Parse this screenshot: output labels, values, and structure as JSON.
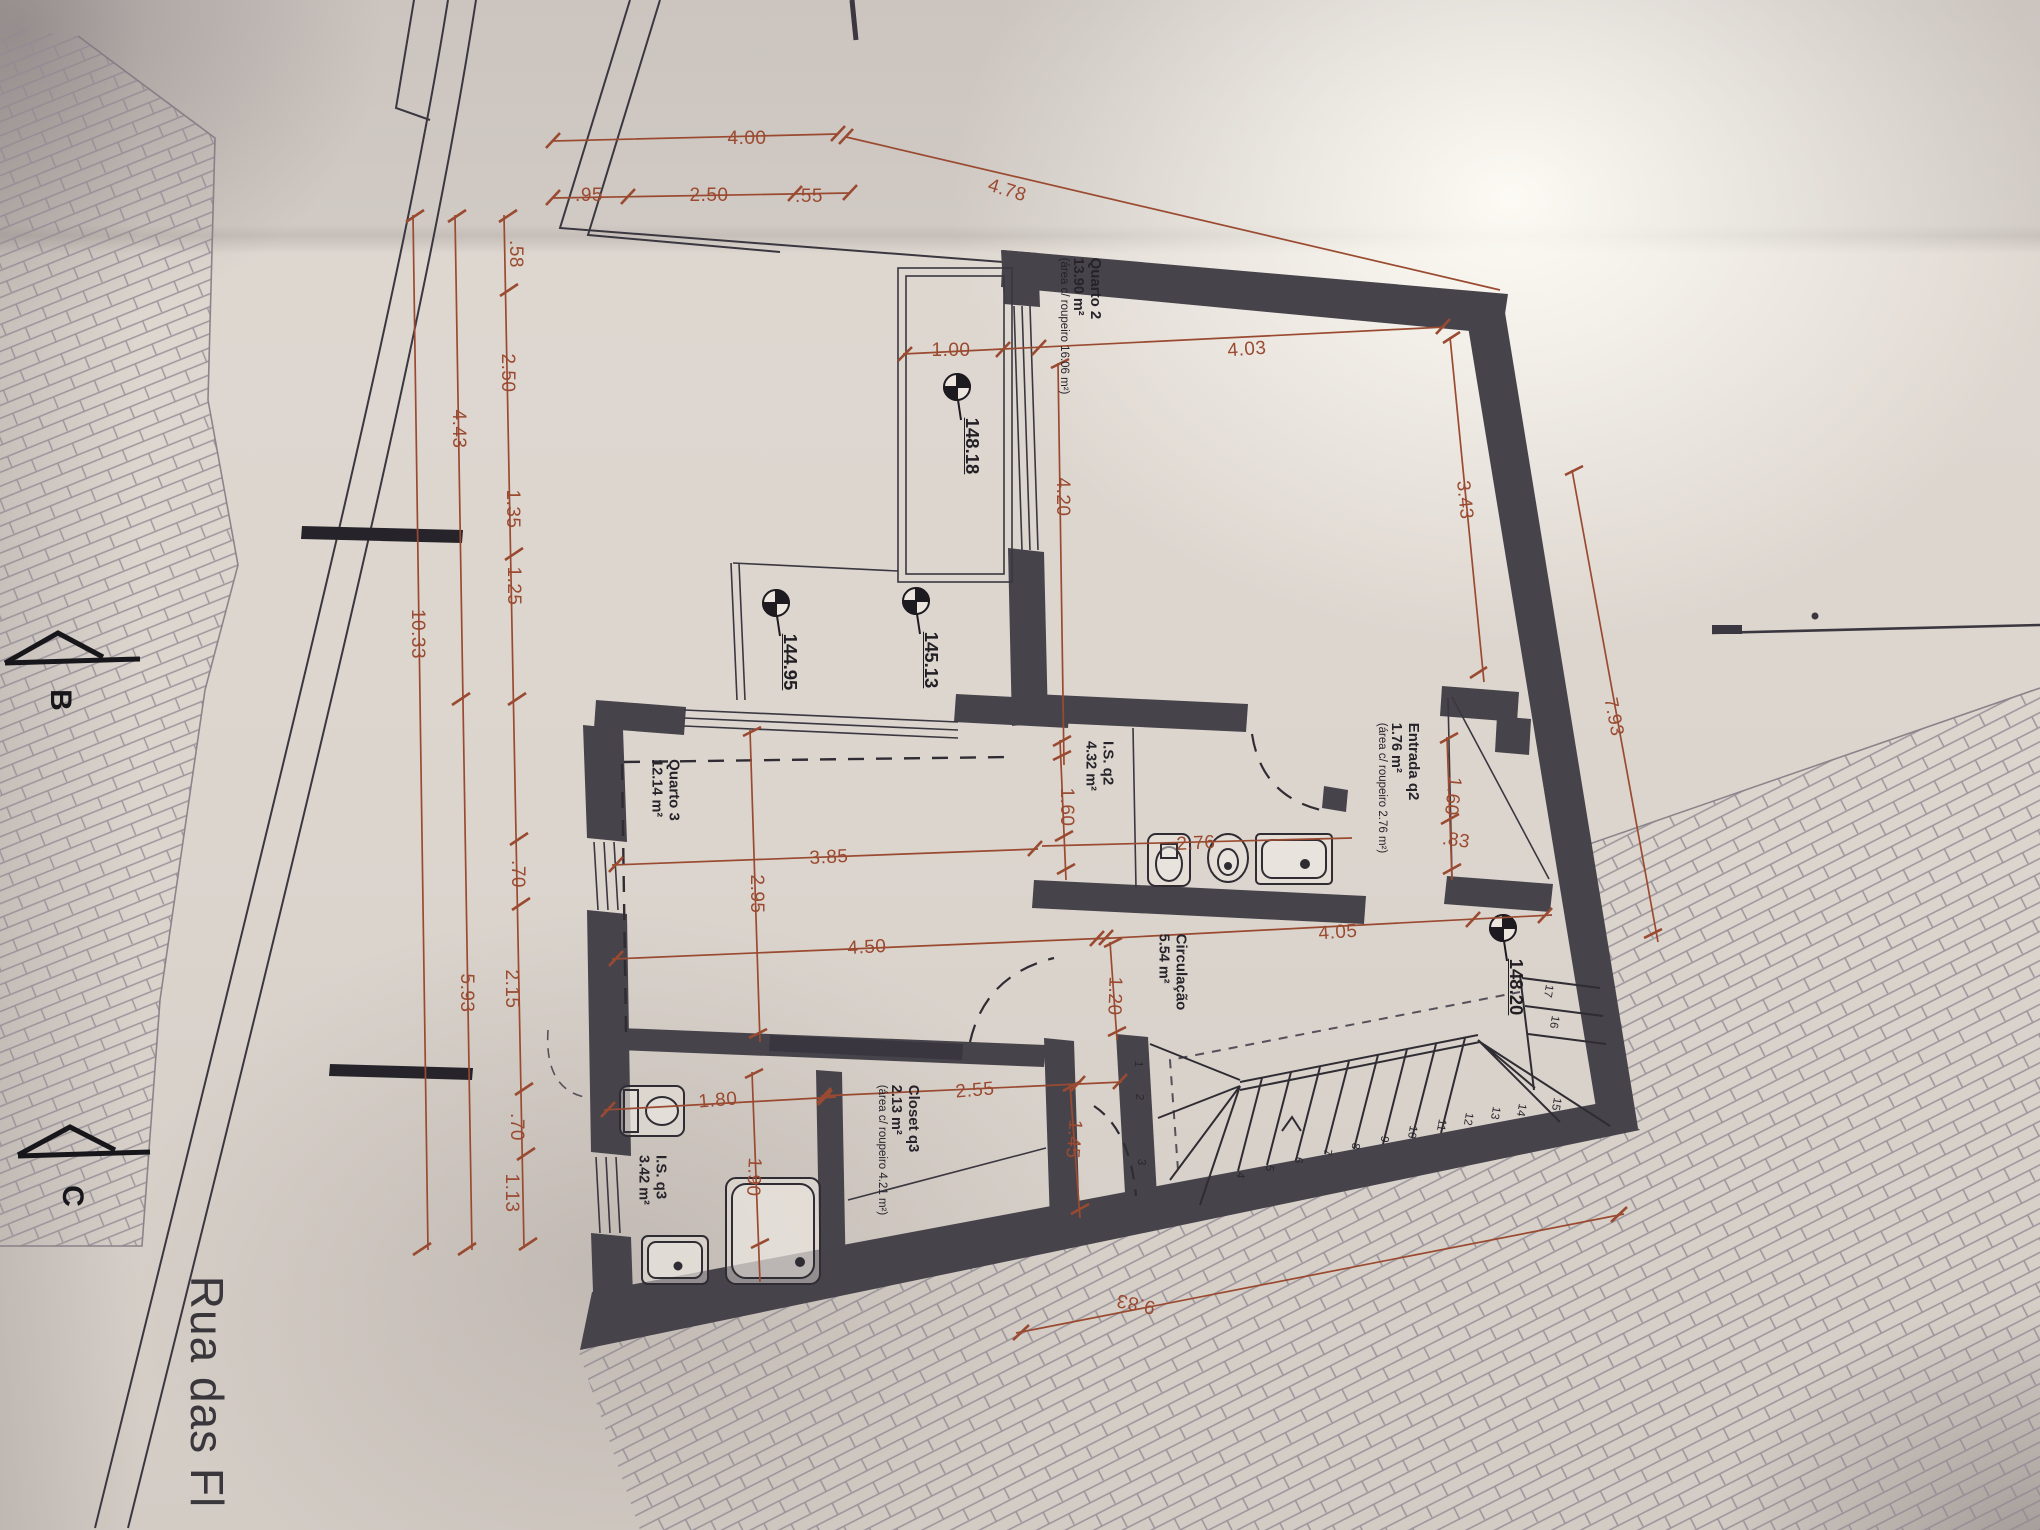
{
  "street": {
    "label": "Rua das Fl"
  },
  "sections": [
    {
      "label": "B"
    },
    {
      "label": "C"
    }
  ],
  "rooms": [
    {
      "name": "Quarto 2",
      "area": "13.90 m²",
      "note": "(área c/ roupeiro 16.06 m²)"
    },
    {
      "name": "Entrada q2",
      "area": "1.76 m²",
      "note": "(área c/ roupeiro 2.76 m²)"
    },
    {
      "name": "I.S. q2",
      "area": "4.32 m²",
      "note": ""
    },
    {
      "name": "Quarto 3",
      "area": "12.14 m²",
      "note": ""
    },
    {
      "name": "Circulação",
      "area": "5.54 m²",
      "note": ""
    },
    {
      "name": "Closet q3",
      "area": "2.13 m²",
      "note": "(área c/ roupeiro 4.21 m²)"
    },
    {
      "name": "I.S. q3",
      "area": "3.42 m²",
      "note": ""
    }
  ],
  "levels": [
    {
      "value": "148.18"
    },
    {
      "value": "144.95"
    },
    {
      "value": "145.13"
    },
    {
      "value": "148.20"
    }
  ],
  "dims": [
    {
      "v": "4.00"
    },
    {
      "v": ".95"
    },
    {
      "v": "2.50"
    },
    {
      "v": ".55"
    },
    {
      "v": "4.78"
    },
    {
      "v": ".58"
    },
    {
      "v": "2.50"
    },
    {
      "v": "1.35"
    },
    {
      "v": "1.25"
    },
    {
      "v": ".70"
    },
    {
      "v": "2.15"
    },
    {
      "v": ".70"
    },
    {
      "v": "1.13"
    },
    {
      "v": "4.43"
    },
    {
      "v": "5.93"
    },
    {
      "v": "10.33"
    },
    {
      "v": "1.00"
    },
    {
      "v": "4.03"
    },
    {
      "v": "4.20"
    },
    {
      "v": "3.43"
    },
    {
      "v": "1.60"
    },
    {
      "v": ".83"
    },
    {
      "v": "7.93"
    },
    {
      "v": "1.60"
    },
    {
      "v": "2.76"
    },
    {
      "v": "3.85"
    },
    {
      "v": "2.95"
    },
    {
      "v": "4.50"
    },
    {
      "v": "1.20"
    },
    {
      "v": "4.05"
    },
    {
      "v": "2.55"
    },
    {
      "v": "1.45"
    },
    {
      "v": "1.80"
    },
    {
      "v": "1.90"
    },
    {
      "v": "9.83"
    }
  ],
  "stairs": {
    "treads": [
      "1",
      "2",
      "3",
      "4",
      "5",
      "6",
      "7",
      "8",
      "9",
      "10",
      "11",
      "12",
      "13",
      "14",
      "15",
      "16",
      "17"
    ]
  },
  "colors": {
    "dim": "#9a4a30",
    "wall": "#47434b",
    "ink": "#312e35",
    "paper": "#dcd5ce"
  }
}
